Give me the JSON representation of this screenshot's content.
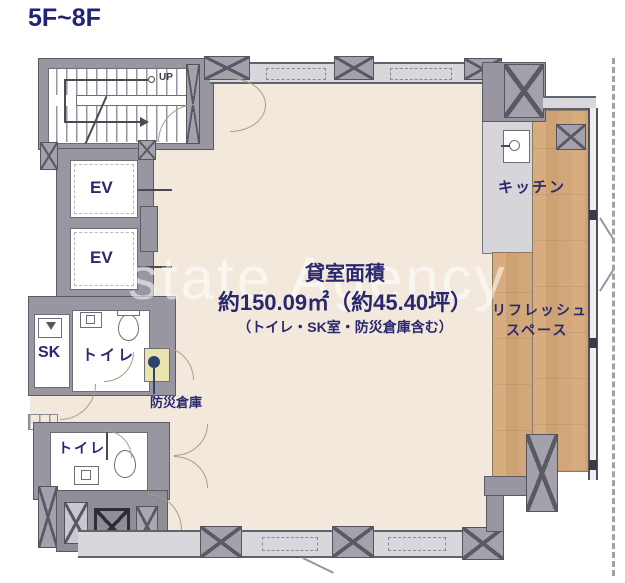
{
  "title": "5F~8F",
  "watermark": "state Agency",
  "area": {
    "heading": "貸室面積",
    "size": "約150.09㎡（約45.40坪）",
    "note": "（トイレ・SK室・防災倉庫含む）"
  },
  "labels": {
    "up": "UP",
    "ev1": "EV",
    "ev2": "EV",
    "sk": "SK",
    "toilet1": "トイレ",
    "toilet2": "トイレ",
    "disaster_storage": "防災倉庫",
    "kitchen": "キッチン",
    "refresh_line1": "リフレッシュ",
    "refresh_line2": "スペース"
  },
  "colors": {
    "label_navy": "#29286f",
    "floor_beige": "#f2e9dc",
    "wall_gray": "#9897a1",
    "window_band": "#d8d8dc",
    "wood_floor": "#d2a87a",
    "storage_yellow": "#e9e3ae"
  }
}
